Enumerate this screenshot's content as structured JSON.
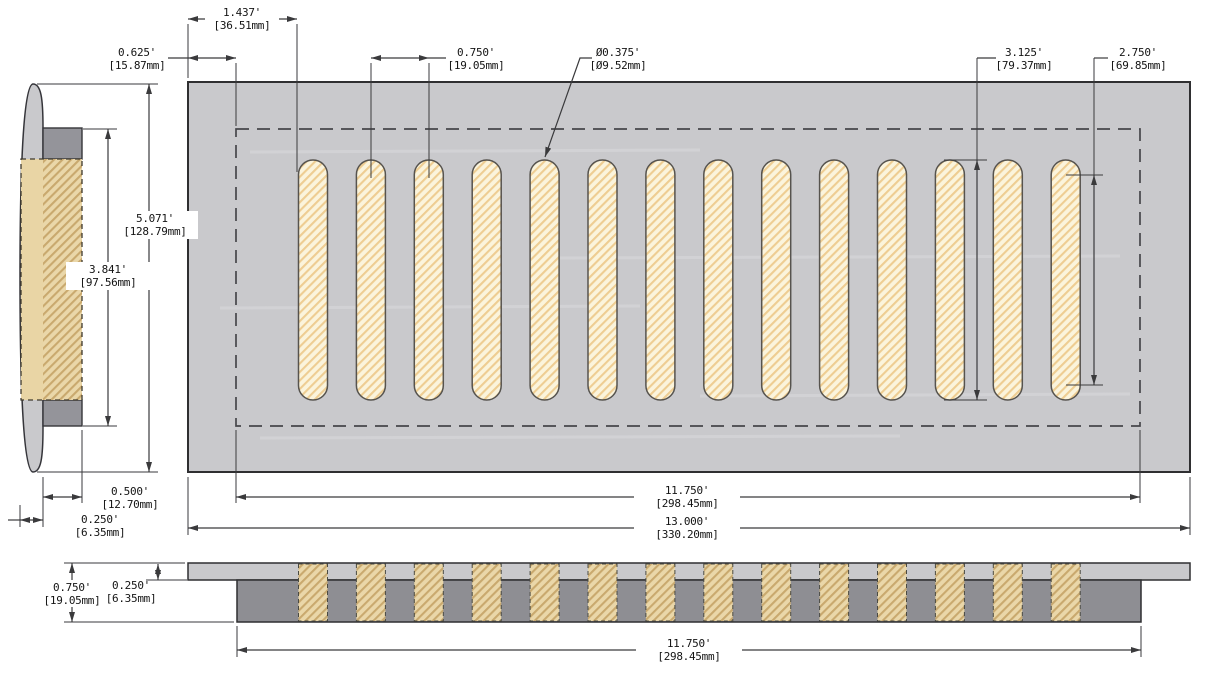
{
  "drawing": {
    "title": "floor-vent-cover-technical-drawing",
    "background": "#ffffff",
    "line_color": "#3a3a3c",
    "text_color": "#141414",
    "plate_fill": "#c9c9cc",
    "duct_fill": "#94949a",
    "duct_fill_front": "#8e8e93",
    "slot_fill": "#fbf4dc",
    "slot_hatch": "#eecd92",
    "section_fill": "#ead7a9",
    "section_hatch": "#c9a96e",
    "views": {
      "top": {
        "name": "top-view",
        "slot_count": 14
      },
      "side": {
        "name": "side-section-view"
      },
      "front": {
        "name": "front-section-view",
        "slot_count": 14
      }
    },
    "dimensions": {
      "d1437": {
        "in": "1.437'",
        "mm": "[36.51mm]"
      },
      "d0625": {
        "in": "0.625'",
        "mm": "[15.87mm]"
      },
      "d0750": {
        "in": "0.750'",
        "mm": "[19.05mm]"
      },
      "d0375": {
        "in": "Ø0.375'",
        "mm": "[Ø9.52mm]"
      },
      "d3125": {
        "in": "3.125'",
        "mm": "[79.37mm]"
      },
      "d2750": {
        "in": "2.750'",
        "mm": "[69.85mm]"
      },
      "d5071": {
        "in": "5.071'",
        "mm": "[128.79mm]"
      },
      "d3841": {
        "in": "3.841'",
        "mm": "[97.56mm]"
      },
      "d0500": {
        "in": "0.500'",
        "mm": "[12.70mm]"
      },
      "d0250_side": {
        "in": "0.250'",
        "mm": "[6.35mm]"
      },
      "d11750_top": {
        "in": "11.750'",
        "mm": "[298.45mm]"
      },
      "d13000": {
        "in": "13.000'",
        "mm": "[330.20mm]"
      },
      "d0750_front": {
        "in": "0.750'",
        "mm": "[19.05mm]"
      },
      "d0250_front": {
        "in": "0.250'",
        "mm": "[6.35mm]"
      },
      "d11750_front": {
        "in": "11.750'",
        "mm": "[298.45mm]"
      }
    }
  }
}
